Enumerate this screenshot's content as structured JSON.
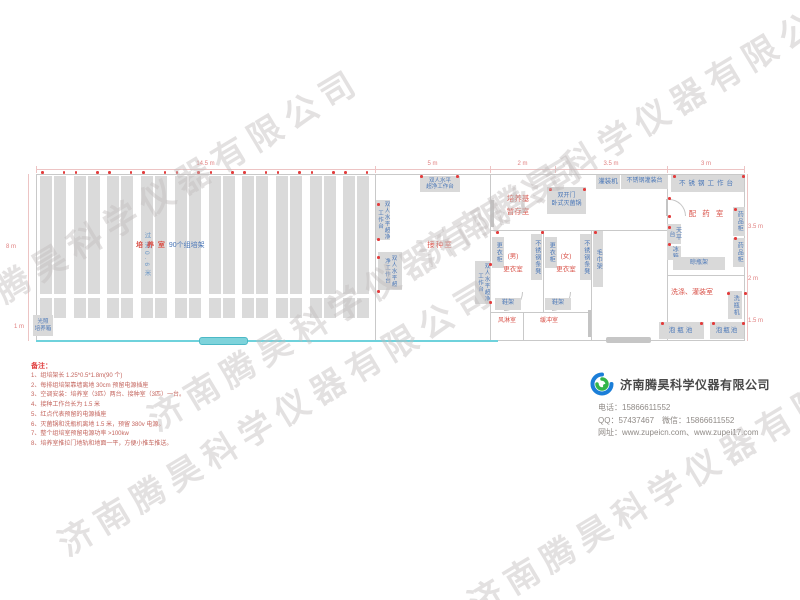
{
  "watermark": {
    "text": "济南腾昊科学仪器有限公司"
  },
  "dims": {
    "top": [
      "14.5 m",
      "5 m",
      "2 m",
      "3.5 m",
      "3 m"
    ],
    "left_height": "8 m",
    "left_small": "1 m",
    "right": [
      "3.5 m",
      "2 m",
      "1.5 m"
    ]
  },
  "rooms": {
    "culture": {
      "name_red": "培 养 室",
      "name_blue": "90个组培架",
      "aisle": "过道0.6米",
      "incubator_l1": "光照",
      "incubator_l2": "培养箱",
      "rack_count": 10
    },
    "inoculation": {
      "name": "接种室",
      "bench": "双人水平超净工作台",
      "bench_l1": "双人水平",
      "bench_l2": "超净工作台"
    },
    "medium_storage": {
      "l1": "培养基",
      "l2": "暂存室",
      "sterilizer_l1": "双开门",
      "sterilizer_l2": "卧式灭菌锅"
    },
    "dressing_male": {
      "l1": "(男)",
      "l2": "更衣室"
    },
    "dressing_female": {
      "l1": "(女)",
      "l2": "更衣室"
    },
    "air_shower": "风淋室",
    "buffer": "缓冲室",
    "dispensing": {
      "name": "配 药 室"
    },
    "washing": {
      "name": "洗涤、灌装室"
    }
  },
  "equipment": {
    "locker": "更衣柜",
    "bench_stool": "不锈钢条凳",
    "towel_rack": "毛巾架",
    "shoe_rack": "鞋架",
    "filling_machine": "灌装机",
    "ss_filling_table": "不锈钢灌装台",
    "ss_worktable": "不锈钢工作台",
    "medicine_cabinet": "药品柜",
    "balance_table": "天平台",
    "fridge": "冰箱",
    "bottle_dry_rack": "晾瓶架",
    "bottle_washer": "洗瓶机",
    "soak_pool": "泡瓶池"
  },
  "notes": {
    "title": "备注：",
    "items": [
      "1、组培架长 1.25*0.5*1.8m(90 个)",
      "2、每排组培架靠墙离地 30cm 预留电源插座",
      "3、空调安装：培养室（3匹）两台、接种室（3匹）一台。",
      "4、接种工作台长为 1.5 米",
      "5、红点代表预留的电源插座",
      "6、灭菌锅和洗瓶机离地 1.5 米，预留 380v 电源。",
      "7、整个组培室预留电源功率 >100kw",
      "8、培养室推拉门地轨和地面一平，方便小推车推送。"
    ]
  },
  "company": {
    "name": "济南腾昊科学仪器有限公司",
    "phone": "电话：15866611552",
    "qq_wechat": "QQ：57437467　微信：15866611552",
    "website": "网址：www.zupeicn.com、www.zupei17.com"
  }
}
